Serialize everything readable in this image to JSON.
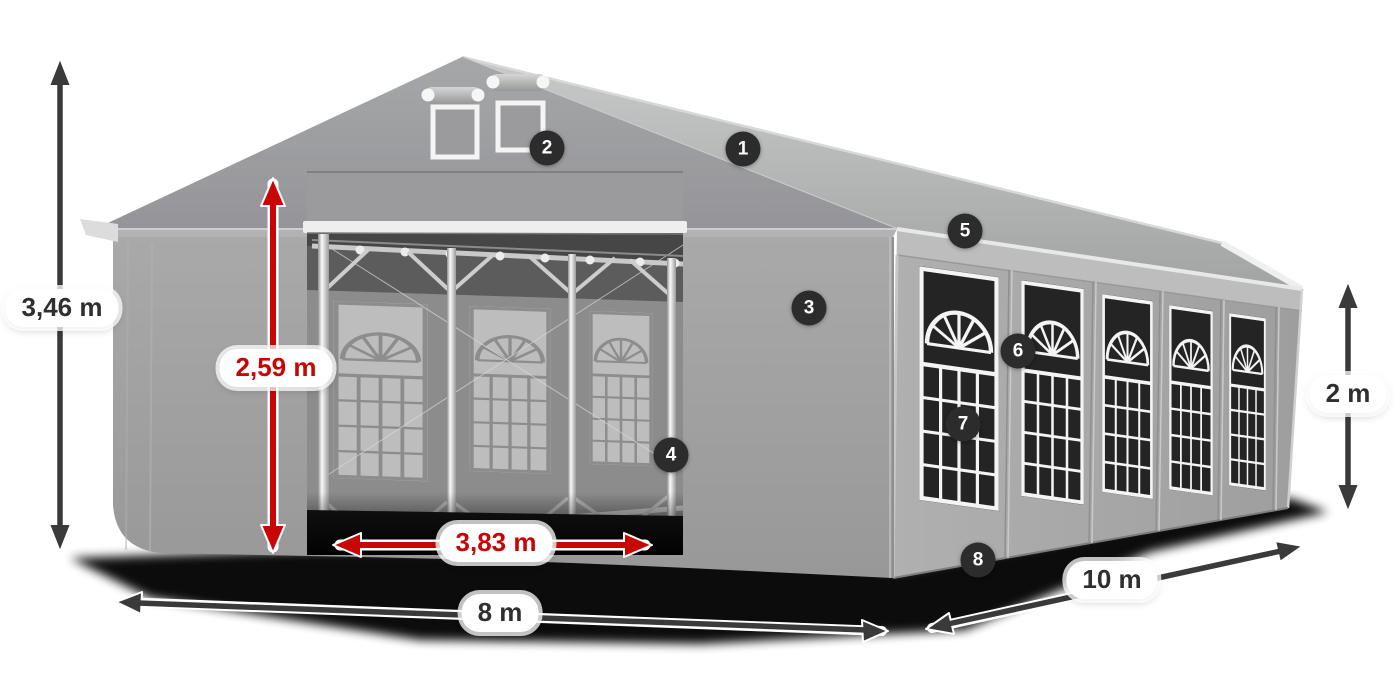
{
  "diagram": {
    "kind": "party-tent-dimension-diagram",
    "colors": {
      "background": "#ffffff",
      "tent_gray": "#a3a3a3",
      "roof_gray": "#b8baba",
      "window_dark": "#242424",
      "window_grill": "#f4f4f4",
      "dimension_arrow_dark": "#3a3a3a",
      "dimension_arrow_red": "#c90606",
      "label_background": "#ffffff",
      "label_text_dark": "#2f2f2f",
      "label_text_red": "#c90606",
      "badge_background": "#2c2c2c",
      "badge_text": "#ffffff"
    },
    "measurements": {
      "total_height": {
        "value": "3,46 m",
        "style": "dark"
      },
      "entrance_height": {
        "value": "2,59 m",
        "style": "red"
      },
      "entrance_width": {
        "value": "3,83 m",
        "style": "red"
      },
      "front_width": {
        "value": "8 m",
        "style": "dark"
      },
      "side_length": {
        "value": "10 m",
        "style": "dark"
      },
      "wall_height": {
        "value": "2 m",
        "style": "dark"
      }
    },
    "markers": [
      {
        "number": "1"
      },
      {
        "number": "2"
      },
      {
        "number": "3"
      },
      {
        "number": "4"
      },
      {
        "number": "5"
      },
      {
        "number": "6"
      },
      {
        "number": "7"
      },
      {
        "number": "8"
      }
    ]
  }
}
